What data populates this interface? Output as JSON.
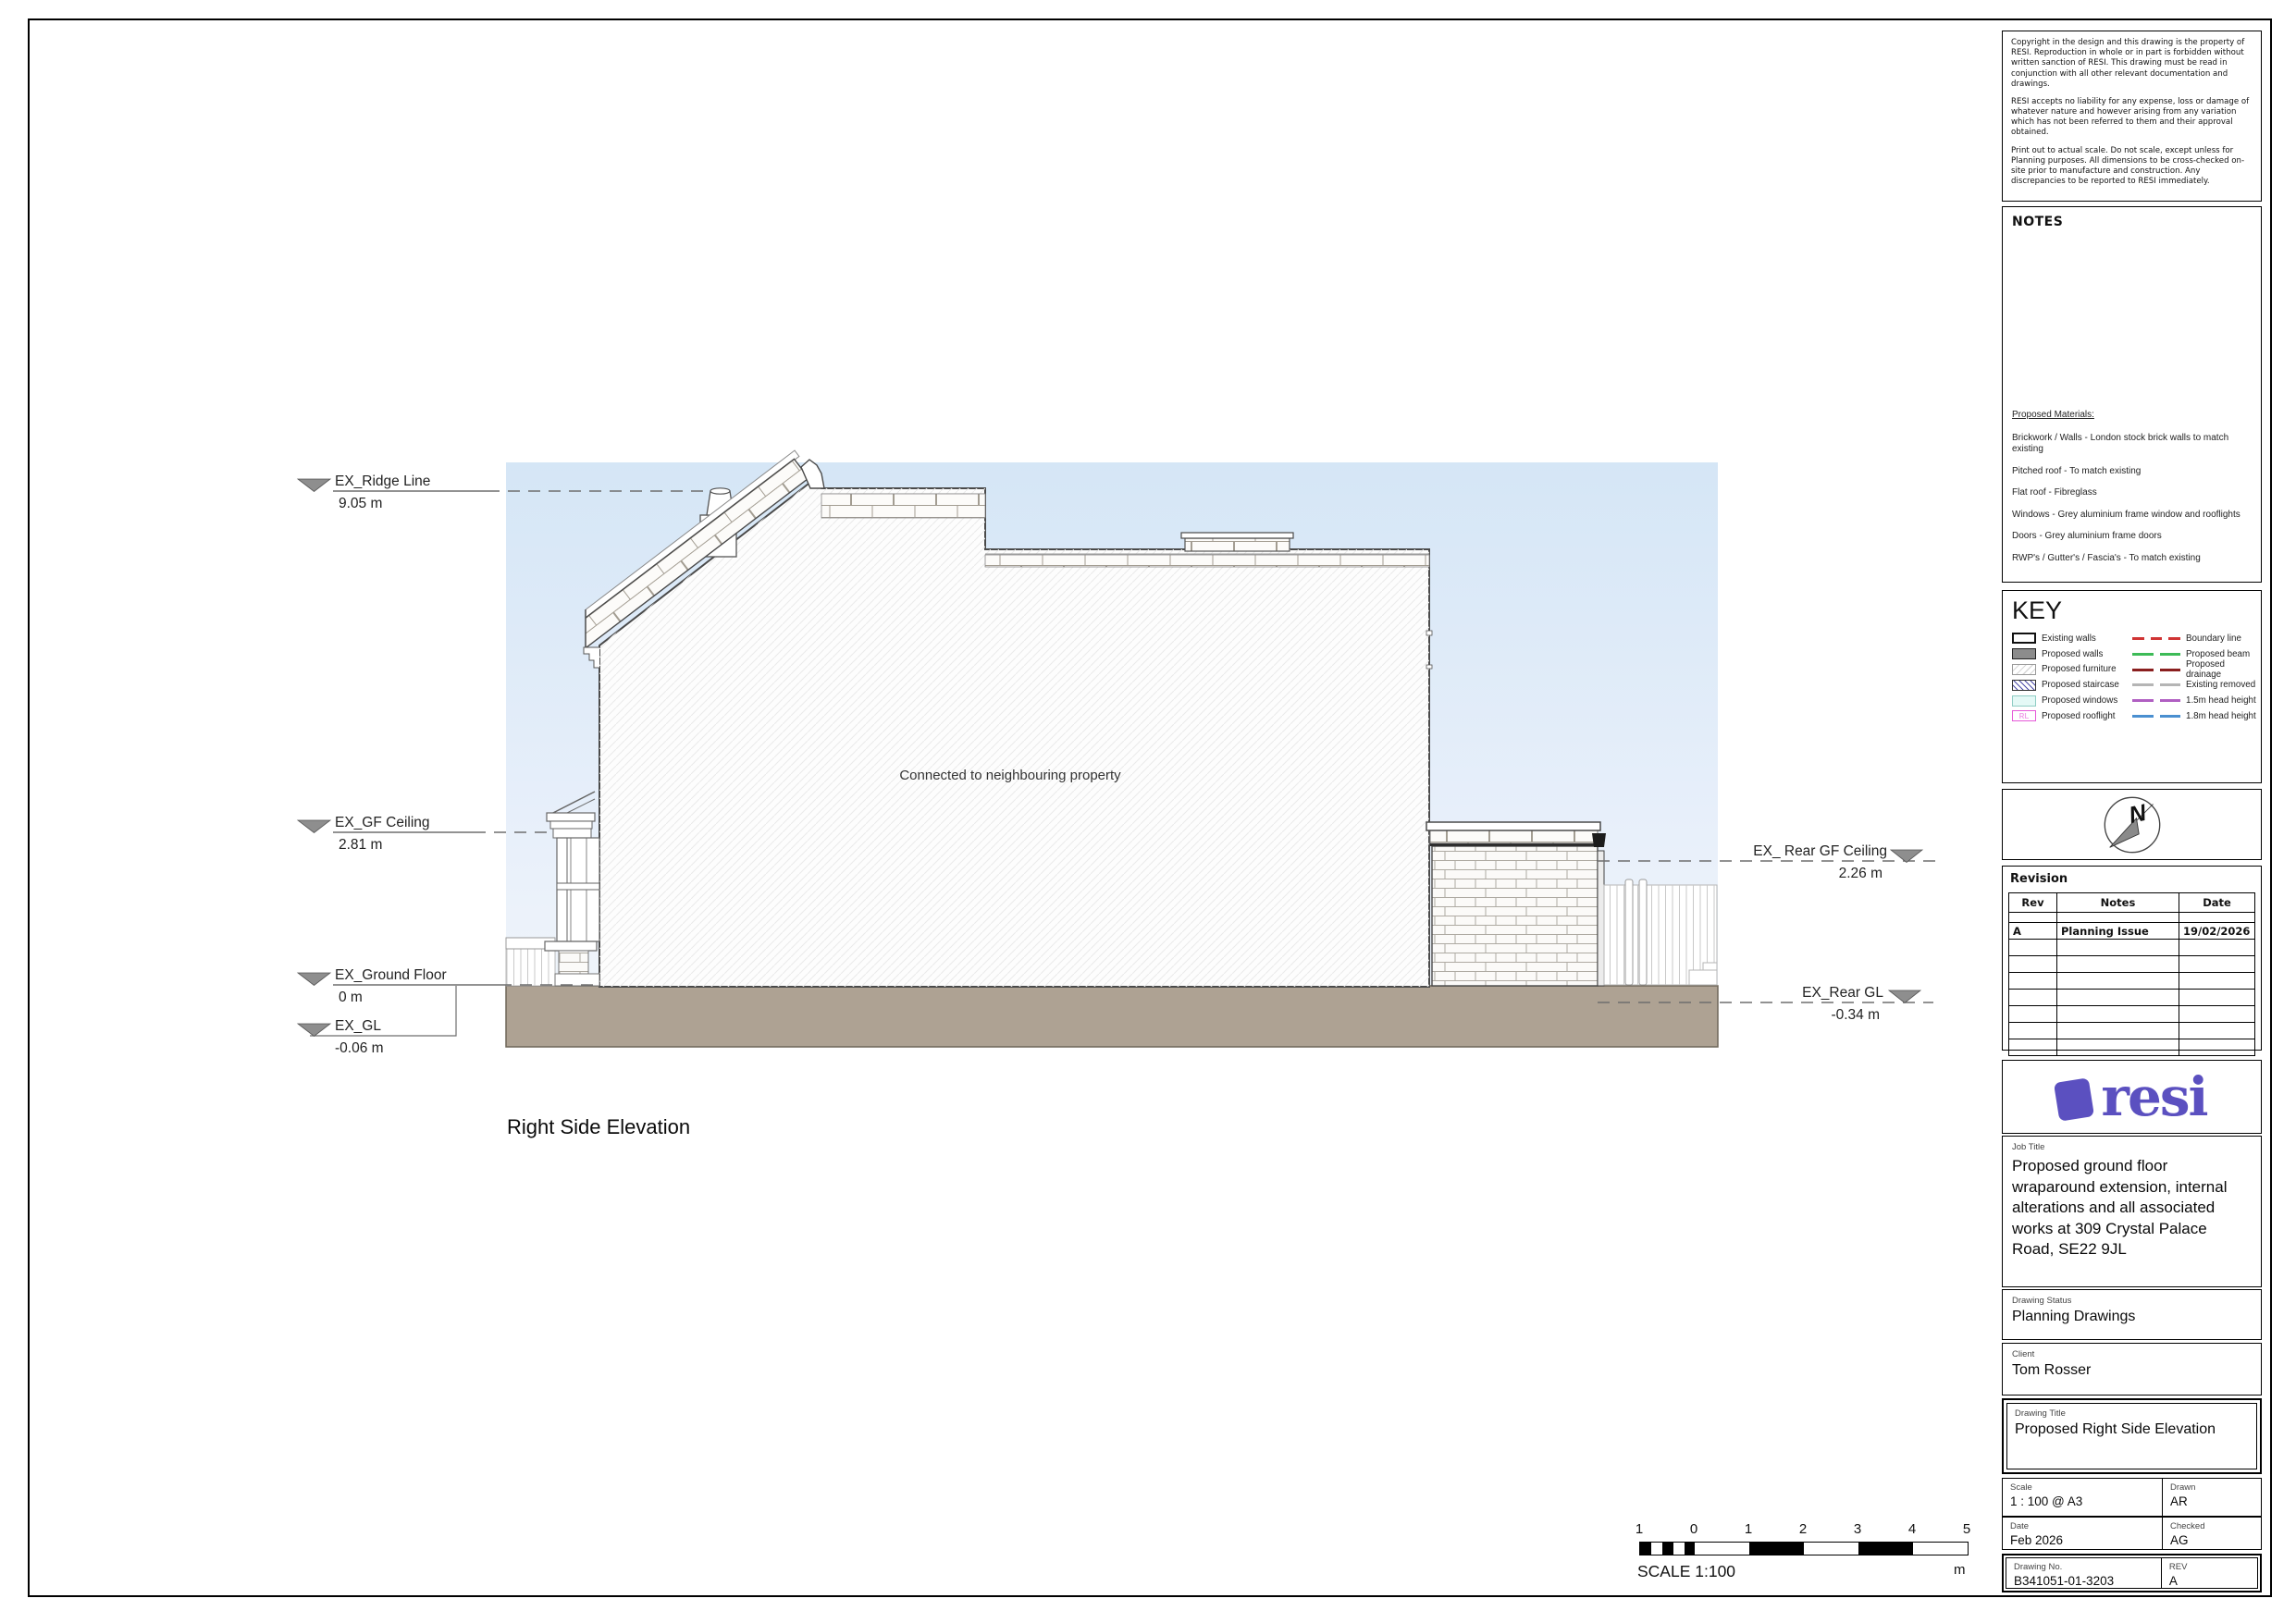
{
  "page": {
    "drawing_label": "Right Side Elevation",
    "connected_note": "Connected to neighbouring property"
  },
  "levels": {
    "ridge": {
      "label": "EX_Ridge Line",
      "value": "9.05 m"
    },
    "gf_ceiling": {
      "label": "EX_GF Ceiling",
      "value": "2.81 m"
    },
    "ground_floor": {
      "label": "EX_Ground Floor",
      "value": "0 m"
    },
    "gl": {
      "label": "EX_GL",
      "value": "-0.06 m"
    },
    "rear_gf_ceiling": {
      "label": "EX_ Rear GF Ceiling",
      "value": "2.26 m"
    },
    "rear_gl": {
      "label": "EX_Rear GL",
      "value": "-0.34 m"
    }
  },
  "scalebar": {
    "labels": [
      "1",
      "0",
      "1",
      "2",
      "3",
      "4",
      "5"
    ],
    "unit": "m",
    "caption": "SCALE 1:100"
  },
  "titleblock": {
    "copyright": {
      "p1": "Copyright in the design and this drawing is the property of RESI. Reproduction in whole or in part is forbidden without written sanction of RESI. This drawing must be read in conjunction with all other relevant documentation and drawings.",
      "p2": "RESI accepts no liability for any expense, loss or damage of whatever nature and however arising from any variation which has not been referred to them and their approval obtained.",
      "p3": "Print out to actual scale. Do not scale, except unless for Planning purposes. All dimensions to be cross-checked on-site prior to manufacture and construction. Any discrepancies to be reported to RESI immediately."
    },
    "notes_heading": "NOTES",
    "materials": {
      "heading": "Proposed Materials:",
      "items": [
        "Brickwork / Walls - London stock brick walls to match existing",
        "Pitched roof - To match existing",
        "Flat roof - Fibreglass",
        "Windows - Grey aluminium frame window and rooflights",
        "Doors - Grey aluminium frame doors",
        "RWP's / Gutter's / Fascia's - To match existing"
      ]
    },
    "key": {
      "heading": "KEY",
      "rooflight_glyph": "RL",
      "fills": [
        {
          "label": "Existing walls"
        },
        {
          "label": "Proposed walls"
        },
        {
          "label": "Proposed furniture"
        },
        {
          "label": "Proposed staircase"
        },
        {
          "label": "Proposed windows"
        },
        {
          "label": "Proposed rooflight"
        }
      ],
      "lines": [
        {
          "label": "Boundary line",
          "color": "#d03434"
        },
        {
          "label": "Proposed beam",
          "color": "#3dbb57"
        },
        {
          "label": "Proposed drainage",
          "color": "#8a1f1f"
        },
        {
          "label": "Existing removed",
          "color": "#b5b5b5"
        },
        {
          "label": "1.5m head height",
          "color": "#b05fc2"
        },
        {
          "label": "1.8m head height",
          "color": "#4a8fd0"
        }
      ]
    },
    "north_label": "N",
    "revision": {
      "heading": "Revision",
      "columns": [
        "Rev",
        "Notes",
        "Date"
      ],
      "rows": [
        {
          "rev": "A",
          "notes": "Planning Issue",
          "date": "19/02/2026"
        }
      ]
    },
    "logo_text": "resi",
    "brand_color": "#5b50c0",
    "job": {
      "label": "Job Title",
      "value": "Proposed ground floor wraparound extension, internal alterations and all associated works at 309 Crystal Palace Road, SE22 9JL"
    },
    "status": {
      "label": "Drawing Status",
      "value": "Planning Drawings"
    },
    "client": {
      "label": "Client",
      "value": "Tom Rosser"
    },
    "drawing_title": {
      "label": "Drawing Title",
      "value": "Proposed Right Side Elevation"
    },
    "scale": {
      "label": "Scale",
      "value": "1 : 100 @ A3"
    },
    "drawn": {
      "label": "Drawn",
      "value": "AR"
    },
    "date": {
      "label": "Date",
      "value": "Feb 2026"
    },
    "checked": {
      "label": "Checked",
      "value": "AG"
    },
    "drawing_no": {
      "label": "Drawing No.",
      "value": "B341051-01-3203"
    },
    "rev": {
      "label": "REV",
      "value": "A"
    }
  }
}
